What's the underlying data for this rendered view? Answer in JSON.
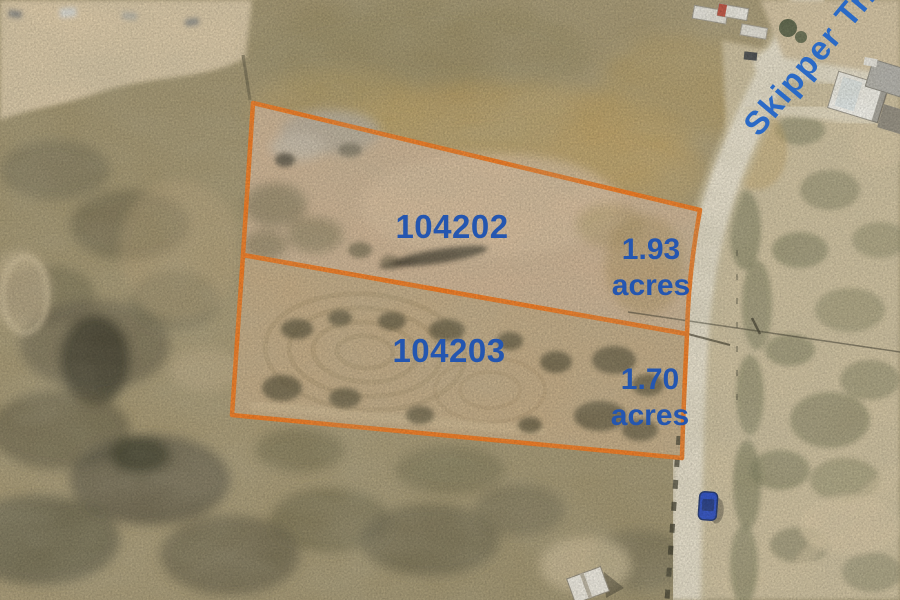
{
  "photo": {
    "description": "aerial drone photo of two land parcels outlined in orange beside a dirt road",
    "road_label": "Skipper Tr.",
    "parcels": [
      {
        "id": "104202",
        "acres": "1.93",
        "unit": "acres"
      },
      {
        "id": "104203",
        "acres": "1.70",
        "unit": "acres"
      }
    ],
    "colors": {
      "boundary_orange": "#f1761b",
      "parcel_label_blue": "#2456b0",
      "road_label_blue": "#2b6ac6"
    }
  }
}
